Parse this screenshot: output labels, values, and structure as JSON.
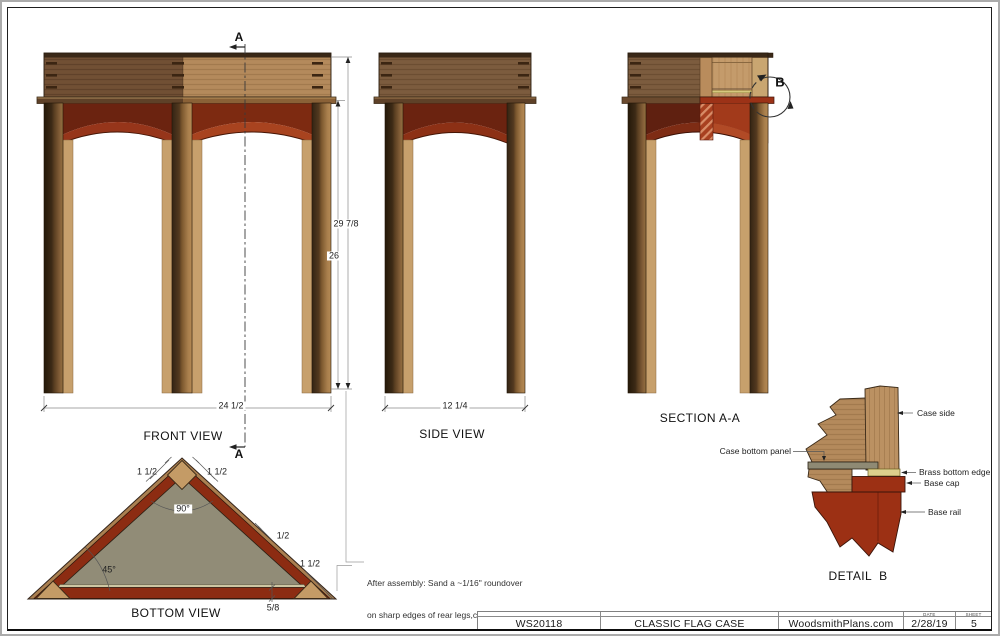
{
  "palette": {
    "wood_light": "#b2885a",
    "wood_dark": "#6f4e33",
    "wood_medium": "#7a5a3d",
    "leg_light": "#a87e4c",
    "apron_dark": "#6b2310",
    "apron_bright": "#a8431f",
    "base_red": "#9c3014",
    "brass": "#ddd08c",
    "panel_gray": "#8f8a74",
    "outline": "#2b1d10"
  },
  "markers": {
    "a_top": "A",
    "a_bottom": "A",
    "b": "B"
  },
  "dims": {
    "height_overall": "29 7/8",
    "height_leg": "26"
  },
  "views": {
    "front": {
      "label": "FRONT VIEW",
      "width": "24 1/2"
    },
    "side": {
      "label": "SIDE VIEW",
      "width": "12 1/4"
    },
    "section": {
      "label": "SECTION A-A"
    },
    "bottom": {
      "label": "BOTTOM VIEW",
      "dims": {
        "apex_left": "1 1/2",
        "apex_right": "1 1/2",
        "apex_angle": "90°",
        "corner_angle": "45°",
        "side_thickness": "1/2",
        "corner_leg": "1 1/2",
        "rail_height": "5/8"
      }
    },
    "detail": {
      "label": "DETAIL  B",
      "callouts": {
        "case_side": "Case side",
        "case_bottom_panel": "Case bottom panel",
        "brass_bottom_edge": "Brass bottom edge",
        "base_cap": "Base cap",
        "base_rail": "Base rail"
      }
    }
  },
  "note": {
    "line1": "After assembly: Sand a ~1/16\" roundover",
    "line2": "on sharp edges of rear legs,case, and case lid."
  },
  "title_block": {
    "plan_number": "WS20118",
    "title": "CLASSIC FLAG CASE",
    "website": "WoodsmithPlans.com",
    "date_label": "DATE",
    "date": "2/28/19",
    "sheet_label": "SHEET",
    "sheet": "5"
  }
}
